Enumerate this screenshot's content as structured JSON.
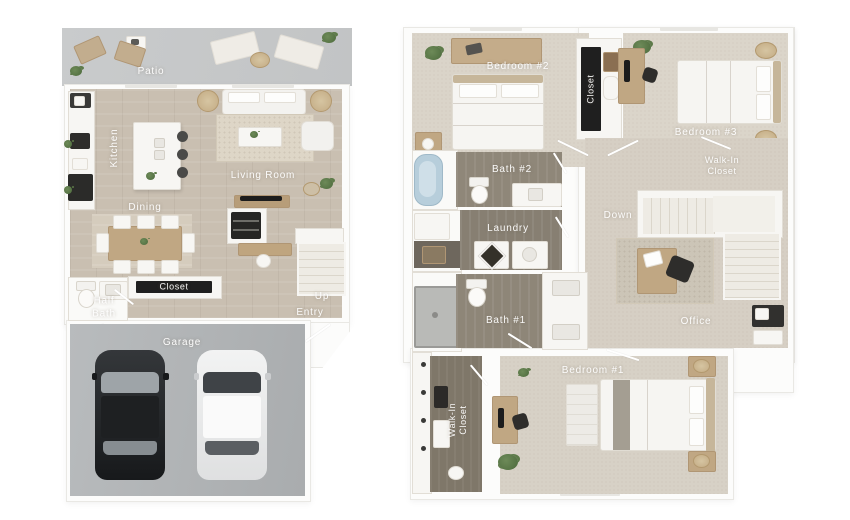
{
  "floor1": {
    "labels": {
      "patio": "Patio",
      "kitchen": "Kitchen",
      "living_room": "Living Room",
      "dining": "Dining",
      "closet": "Closet",
      "half_bath": "Half Bath",
      "up": "Up",
      "entry": "Entry",
      "garage": "Garage"
    }
  },
  "floor2": {
    "labels": {
      "bedroom2": "Bedroom #2",
      "closet": "Closet",
      "bedroom3": "Bedroom #3",
      "bath2": "Bath #2",
      "walk_in_closet_a": "Walk-In Closet",
      "laundry": "Laundry",
      "down": "Down",
      "bath1": "Bath #1",
      "office": "Office",
      "walk_in_closet_b": "Walk-In Closet",
      "bedroom1": "Bedroom #1"
    }
  },
  "colors": {
    "page_bg": "#ffffff",
    "wall_white": "#fcfcfb",
    "wood_floor": "#c9bfb1",
    "dining_rug_wood": "#d5ccbd",
    "patio_concrete": "#c7c9ca",
    "garage_concrete": "#b0b3b5",
    "carpet_upstairs": "#d8d2c7",
    "bath_gray_wood": "#8f8779",
    "walkin_closet_floor": "#7f7769",
    "closet_dark_band": "#1f1f1f",
    "label_text": "#ffffff",
    "bathtub_blue": "#b7cedb",
    "furniture_tan": "#c0a783",
    "plant_green": "#5d7a49",
    "car_dark": "#2a2d2f",
    "car_white": "#e9eaeb"
  }
}
